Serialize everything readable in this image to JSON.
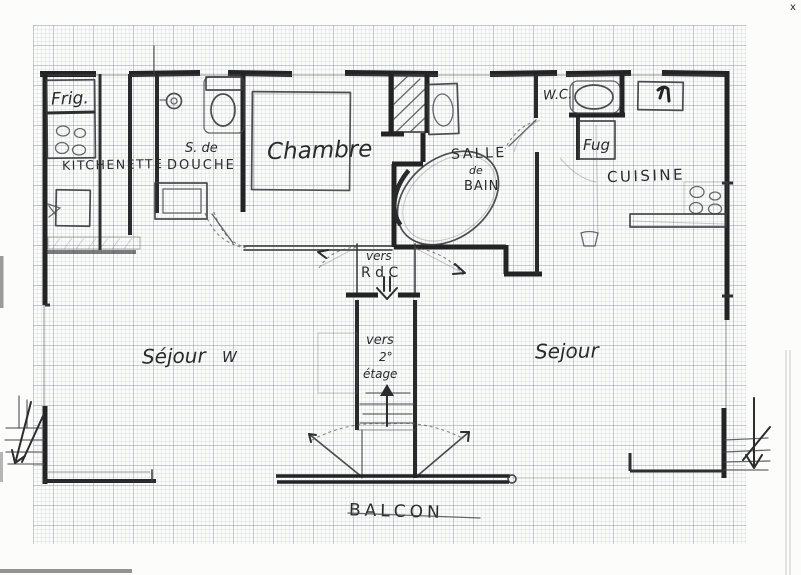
{
  "document_type": "hand-drawn floor plan on graph paper",
  "colors": {
    "pencil": "#2b2b2e",
    "paper": "#fbfbf8",
    "grid": "#6c7a96"
  },
  "labels": {
    "frig": "Frig.",
    "kitchenette": "KITCHENETTE",
    "shower_l1": "S. de",
    "shower_l2": "DOUCHE",
    "chambre": "Chambre",
    "bath_l1": "SALLE",
    "bath_l2": "de",
    "bath_l3": "BAIN",
    "wc": "W.C.",
    "fug": "Fug",
    "cuisine": "CUISINE",
    "sejour_left": "Séjour",
    "sejour_left_w": "W",
    "sejour_right": "Sejour",
    "balcon": "BALCON",
    "vers_rdc_l1": "vers",
    "vers_rdc_l2": "R d C",
    "vers_etage_l1": "vers",
    "vers_etage_l2": "2°",
    "vers_etage_l3": "étage",
    "corner_mark": "x"
  }
}
